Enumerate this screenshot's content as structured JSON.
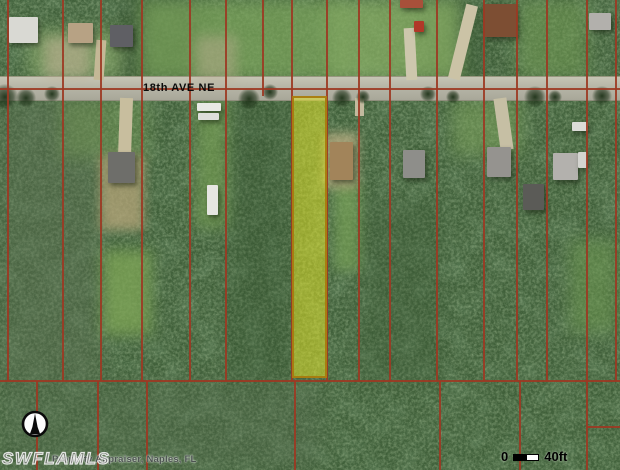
{
  "map": {
    "street_label": "18th AVE NE",
    "watermark": "SWFLAMLS",
    "attribution": "Property Appraiser, Naples, FL",
    "scale_bar": {
      "start": "0",
      "end_label": "40ft"
    },
    "colors": {
      "parcel_line": "#9c3822",
      "highlight_fill": "rgba(234,234,38,0.5)",
      "highlight_border": "rgba(168,122,14,0.95)",
      "road": "#b6b5a6",
      "forest_base": "#40603a"
    },
    "highlighted_parcel": {
      "x": 292,
      "y": 96,
      "w": 35,
      "h": 282
    },
    "road_band": {
      "y": 76,
      "h": 23
    },
    "street_label_pos": {
      "x": 143,
      "y": 82
    },
    "scale_bar_pos": {
      "x": 501,
      "y": 449
    },
    "watermark_pos": {
      "x": 2,
      "y": 449
    },
    "attribution_pos": {
      "x": 52,
      "y": 454
    },
    "compass": {
      "x": 21,
      "y": 410,
      "size": 28
    }
  },
  "render": {
    "tints": [
      {
        "x": 0,
        "y": 96,
        "w": 100,
        "h": 286,
        "c": "#5e7054",
        "o": 0.4,
        "blur": 10
      },
      {
        "x": 0,
        "y": 382,
        "w": 320,
        "h": 88,
        "c": "#566a4f",
        "o": 0.3,
        "blur": 10
      },
      {
        "x": 120,
        "y": 0,
        "w": 80,
        "h": 80,
        "c": "#2f4a2a",
        "o": 0.4,
        "blur": 8
      },
      {
        "x": 425,
        "y": 0,
        "w": 60,
        "h": 80,
        "c": "#31502c",
        "o": 0.35,
        "blur": 8
      },
      {
        "x": 230,
        "y": 98,
        "w": 62,
        "h": 284,
        "c": "#33512d",
        "o": 0.3,
        "blur": 10
      },
      {
        "x": 360,
        "y": 200,
        "w": 80,
        "h": 182,
        "c": "#3a5834",
        "o": 0.3,
        "blur": 10
      }
    ],
    "grass": [
      {
        "x": 140,
        "y": 0,
        "w": 200,
        "h": 80,
        "c": "#7da65c",
        "o": 0.7,
        "blur": 8
      },
      {
        "x": 330,
        "y": 0,
        "w": 130,
        "h": 80,
        "c": "#88ae64",
        "o": 0.75,
        "blur": 8
      },
      {
        "x": 28,
        "y": 30,
        "w": 95,
        "h": 48,
        "c": "#8fae6e",
        "o": 0.6,
        "blur": 8
      },
      {
        "x": 518,
        "y": 0,
        "w": 70,
        "h": 78,
        "c": "#739c54",
        "o": 0.55,
        "blur": 8
      },
      {
        "x": 103,
        "y": 250,
        "w": 48,
        "h": 85,
        "c": "#7fa656",
        "o": 0.75,
        "blur": 7
      },
      {
        "x": 196,
        "y": 98,
        "w": 32,
        "h": 130,
        "c": "#79a254",
        "o": 0.6,
        "blur": 7
      },
      {
        "x": 334,
        "y": 183,
        "w": 26,
        "h": 88,
        "c": "#7ca659",
        "o": 0.65,
        "blur": 6
      },
      {
        "x": 570,
        "y": 240,
        "w": 48,
        "h": 92,
        "c": "#6f9a50",
        "o": 0.5,
        "blur": 8
      },
      {
        "x": 452,
        "y": 100,
        "w": 70,
        "h": 55,
        "c": "#81a75e",
        "o": 0.5,
        "blur": 8
      },
      {
        "x": 60,
        "y": 98,
        "w": 90,
        "h": 60,
        "c": "#7aa058",
        "o": 0.4,
        "blur": 8
      }
    ],
    "dirt": [
      {
        "x": 100,
        "y": 155,
        "w": 44,
        "h": 75,
        "c": "#b5a478",
        "o": 0.75,
        "blur": 5
      },
      {
        "x": 324,
        "y": 133,
        "w": 34,
        "h": 55,
        "c": "#c6b488",
        "o": 0.7,
        "blur": 5
      },
      {
        "x": 45,
        "y": 38,
        "w": 45,
        "h": 40,
        "c": "#bdb092",
        "o": 0.6,
        "blur": 6
      },
      {
        "x": 196,
        "y": 36,
        "w": 40,
        "h": 44,
        "c": "#b9ac8e",
        "o": 0.5,
        "blur": 6
      }
    ],
    "driveways": [
      {
        "x": 119,
        "y": 98,
        "w": 13,
        "h": 60,
        "c": "#c8be9e",
        "rot": 2
      },
      {
        "x": 405,
        "y": 28,
        "w": 11,
        "h": 52,
        "c": "#cdc7ad",
        "rot": -3
      },
      {
        "x": 457,
        "y": 4,
        "w": 12,
        "h": 76,
        "c": "#cbc3a6",
        "rot": 14
      },
      {
        "x": 497,
        "y": 98,
        "w": 13,
        "h": 52,
        "c": "#c6bfa4",
        "rot": -8
      },
      {
        "x": 355,
        "y": 98,
        "w": 9,
        "h": 18,
        "c": "#c2ba9e",
        "rot": 0
      },
      {
        "x": 95,
        "y": 40,
        "w": 10,
        "h": 40,
        "c": "#c4b896",
        "rot": 4
      }
    ],
    "canopies": [
      {
        "x": -8,
        "y": 84,
        "s": 26
      },
      {
        "x": 16,
        "y": 88,
        "s": 20
      },
      {
        "x": 44,
        "y": 86,
        "s": 16
      },
      {
        "x": 238,
        "y": 88,
        "s": 22
      },
      {
        "x": 262,
        "y": 84,
        "s": 16
      },
      {
        "x": 332,
        "y": 88,
        "s": 20
      },
      {
        "x": 356,
        "y": 90,
        "s": 14
      },
      {
        "x": 420,
        "y": 86,
        "s": 16
      },
      {
        "x": 446,
        "y": 90,
        "s": 14
      },
      {
        "x": 524,
        "y": 86,
        "s": 22
      },
      {
        "x": 548,
        "y": 90,
        "s": 14
      },
      {
        "x": 592,
        "y": 86,
        "s": 20
      }
    ],
    "houses": [
      {
        "x": 9,
        "y": 17,
        "w": 29,
        "h": 26,
        "c": "#d9d9d3"
      },
      {
        "x": 68,
        "y": 23,
        "w": 25,
        "h": 20,
        "c": "#b7a284"
      },
      {
        "x": 110,
        "y": 25,
        "w": 23,
        "h": 22,
        "c": "#5f5f64"
      },
      {
        "x": 400,
        "y": 0,
        "w": 23,
        "h": 8,
        "c": "#a8503a"
      },
      {
        "x": 414,
        "y": 21,
        "w": 10,
        "h": 11,
        "c": "#b03828"
      },
      {
        "x": 483,
        "y": 4,
        "w": 34,
        "h": 33,
        "c": "#7d4e33"
      },
      {
        "x": 589,
        "y": 13,
        "w": 22,
        "h": 17,
        "c": "#b2b0ac"
      },
      {
        "x": 108,
        "y": 152,
        "w": 27,
        "h": 31,
        "c": "#6e6e6a"
      },
      {
        "x": 197,
        "y": 103,
        "w": 24,
        "h": 8,
        "c": "#e9e9e4"
      },
      {
        "x": 198,
        "y": 113,
        "w": 21,
        "h": 7,
        "c": "#dededa"
      },
      {
        "x": 207,
        "y": 185,
        "w": 11,
        "h": 30,
        "c": "#e6e6e1"
      },
      {
        "x": 330,
        "y": 142,
        "w": 23,
        "h": 38,
        "c": "#a2845a"
      },
      {
        "x": 403,
        "y": 150,
        "w": 22,
        "h": 28,
        "c": "#8e8e8a"
      },
      {
        "x": 487,
        "y": 147,
        "w": 24,
        "h": 30,
        "c": "#95938f"
      },
      {
        "x": 523,
        "y": 184,
        "w": 21,
        "h": 26,
        "c": "#5b5b57"
      },
      {
        "x": 553,
        "y": 153,
        "w": 25,
        "h": 27,
        "c": "#b3b1ad"
      },
      {
        "x": 572,
        "y": 122,
        "w": 16,
        "h": 9,
        "c": "#dcdcd8"
      },
      {
        "x": 578,
        "y": 152,
        "w": 9,
        "h": 16,
        "c": "#d4d4d0"
      }
    ],
    "lines_v": [
      {
        "x": 8,
        "y1": 0,
        "y2": 381
      },
      {
        "x": 63,
        "y1": 0,
        "y2": 381
      },
      {
        "x": 101,
        "y1": 0,
        "y2": 381
      },
      {
        "x": 142,
        "y1": 0,
        "y2": 381
      },
      {
        "x": 190,
        "y1": 0,
        "y2": 381
      },
      {
        "x": 226,
        "y1": 0,
        "y2": 381
      },
      {
        "x": 263,
        "y1": 0,
        "y2": 96
      },
      {
        "x": 292,
        "y1": 0,
        "y2": 381
      },
      {
        "x": 327,
        "y1": 0,
        "y2": 381
      },
      {
        "x": 359,
        "y1": 0,
        "y2": 381
      },
      {
        "x": 390,
        "y1": 0,
        "y2": 381
      },
      {
        "x": 437,
        "y1": 0,
        "y2": 381
      },
      {
        "x": 484,
        "y1": 0,
        "y2": 381
      },
      {
        "x": 517,
        "y1": 0,
        "y2": 381
      },
      {
        "x": 547,
        "y1": 0,
        "y2": 381
      },
      {
        "x": 587,
        "y1": 0,
        "y2": 381
      },
      {
        "x": 616,
        "y1": 0,
        "y2": 381
      },
      {
        "x": 37,
        "y1": 381,
        "y2": 470
      },
      {
        "x": 98,
        "y1": 381,
        "y2": 470
      },
      {
        "x": 147,
        "y1": 381,
        "y2": 470
      },
      {
        "x": 295,
        "y1": 381,
        "y2": 470
      },
      {
        "x": 440,
        "y1": 381,
        "y2": 470
      },
      {
        "x": 520,
        "y1": 381,
        "y2": 470
      },
      {
        "x": 587,
        "y1": 381,
        "y2": 470
      }
    ],
    "lines_h": [
      {
        "y": 89,
        "x1": 0,
        "x2": 620
      },
      {
        "y": 381,
        "x1": 0,
        "x2": 620
      },
      {
        "y": 427,
        "x1": 587,
        "x2": 620
      }
    ]
  }
}
